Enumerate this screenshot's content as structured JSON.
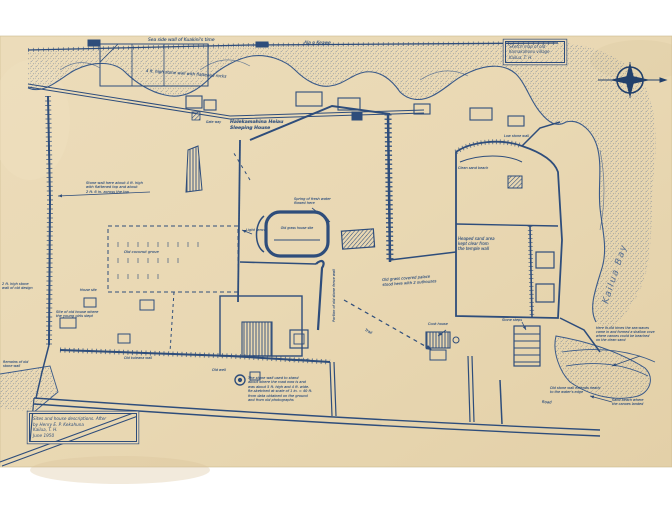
{
  "document": {
    "kind": "scanned hand-drawn survey map, blue ink on cream paper",
    "orientation_note": "compass rose upper right, shoreline along top and right"
  },
  "colors": {
    "background": "#ffffff",
    "paper": "#e9d8b5",
    "paper_dark": "#e0cda4",
    "ink": "#2e4d7b",
    "ink_light": "#5b76a4",
    "stipple": "#4a6590"
  },
  "title_block_top_right": {
    "text": "Sketch map of old\nKamakahonu village\nKailua, T. H."
  },
  "title_block_bottom_left": {
    "text": "Sites and house descriptions. After\nby Henry E. P. Kekahuna\nKailua, T. H.\nJune 1950"
  },
  "bay_label": {
    "text": "Kailua Bay"
  },
  "compass": {
    "type": "compass-rose",
    "points": 4
  },
  "annotations": [
    {
      "id": "top-road-left",
      "text": "Sea side wall of Kuakini's time"
    },
    {
      "id": "top-road-right",
      "text": "Ala o Keawe"
    },
    {
      "id": "diagonal-wall",
      "text": "4 ft. high stone wall with flattened rocks"
    },
    {
      "id": "heiau",
      "text": "Halekamahina Heiau\nSleeping House"
    },
    {
      "id": "left-wall-note",
      "text": "Stone wall here about 4 ft. high\nwith flattened top and about\n2 ft. 6 in. across the top"
    },
    {
      "id": "left-edge-note",
      "text": "2 ft. high stone\nwall of old design"
    },
    {
      "id": "girls-house",
      "text": "Site of old house where\nthe young girls slept"
    },
    {
      "id": "grove",
      "text": "Old coconut grove"
    },
    {
      "id": "light-fence",
      "text": "Light fence"
    },
    {
      "id": "fence-vertical",
      "text": "Portion of old stone fence wall"
    },
    {
      "id": "oval-house",
      "text": "Old grass house site"
    },
    {
      "id": "spring",
      "text": "Spring of fresh water\nflowed here"
    },
    {
      "id": "palace-note",
      "text": "Old grass covered palace\nstood here with 2 outhouses"
    },
    {
      "id": "sand-pile",
      "text": "Heaped sand area\nkept clear from\nthe temple wall"
    },
    {
      "id": "low-wall",
      "text": "Low stone wall"
    },
    {
      "id": "sand-beach",
      "text": "Clean sand beach"
    },
    {
      "id": "right-note",
      "text": "Here in old times the sea waves\ncame in and formed a shallow cove\nwhere canoes could be beached\non the clean sand"
    },
    {
      "id": "bottom-note",
      "text": "The stone wall used to stand\nabout where the road now is and\nwas about 5 ft. high and 4 ft. wide.\nRe-sketched at scale of 1 in. = 40 ft.\nfrom data obtained on the ground\nand from old photographs"
    },
    {
      "id": "well",
      "text": "Old well"
    },
    {
      "id": "road",
      "text": "Road"
    },
    {
      "id": "br-wall-note",
      "text": "Old stone wall extends nearly\nto the water's edge"
    },
    {
      "id": "br-beach",
      "text": "Sand beach where\nthe canoes landed"
    },
    {
      "id": "steps",
      "text": "Stone steps"
    },
    {
      "id": "cook-house",
      "text": "Cook house"
    },
    {
      "id": "trail",
      "text": "Trail"
    },
    {
      "id": "pathway",
      "text": "Old pathway"
    },
    {
      "id": "kuleana",
      "text": "Old kuleana wall"
    },
    {
      "id": "bl-shore",
      "text": "Remains of old\nstone wall"
    },
    {
      "id": "gateway",
      "text": "Gate way"
    },
    {
      "id": "house-site",
      "text": "House site"
    }
  ]
}
